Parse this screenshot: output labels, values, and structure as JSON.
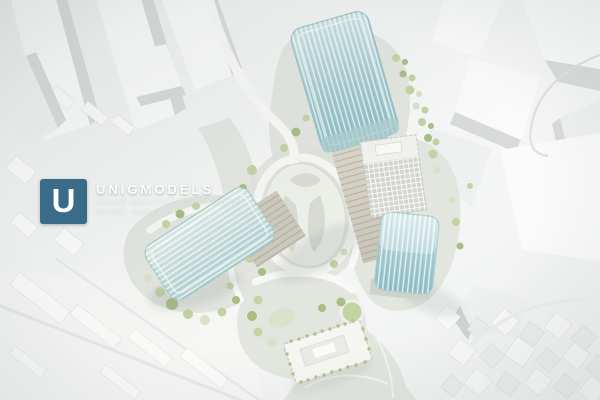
{
  "image": {
    "type": "photograph",
    "subject": "aerial view of a white architectural scale model: three teal glass towers, a grey gridded tower, landscaped loop courtyard with trees, low podium building, surrounded by plain white context-city blocks"
  },
  "watermark": {
    "logo_letter": "U",
    "brand": "UNIGMODELS",
    "tagline_line1": "SCALE ARCHITECTURAL MODEL",
    "tagline_line2": "MODEL MAKING"
  },
  "palette": {
    "background": "#f2f4f3",
    "context_white": "#fafbfa",
    "context_shadow": "#d8dbda",
    "site_base": "#e3e5df",
    "glass_teal": "#a7ccd2",
    "glass_teal_light": "#cfe4e4",
    "tower_floors": "#d8d5c9",
    "greenery": "#c4d3a2",
    "greenery_dark": "#a9bd85",
    "logo_blue": "#3a6b89"
  }
}
